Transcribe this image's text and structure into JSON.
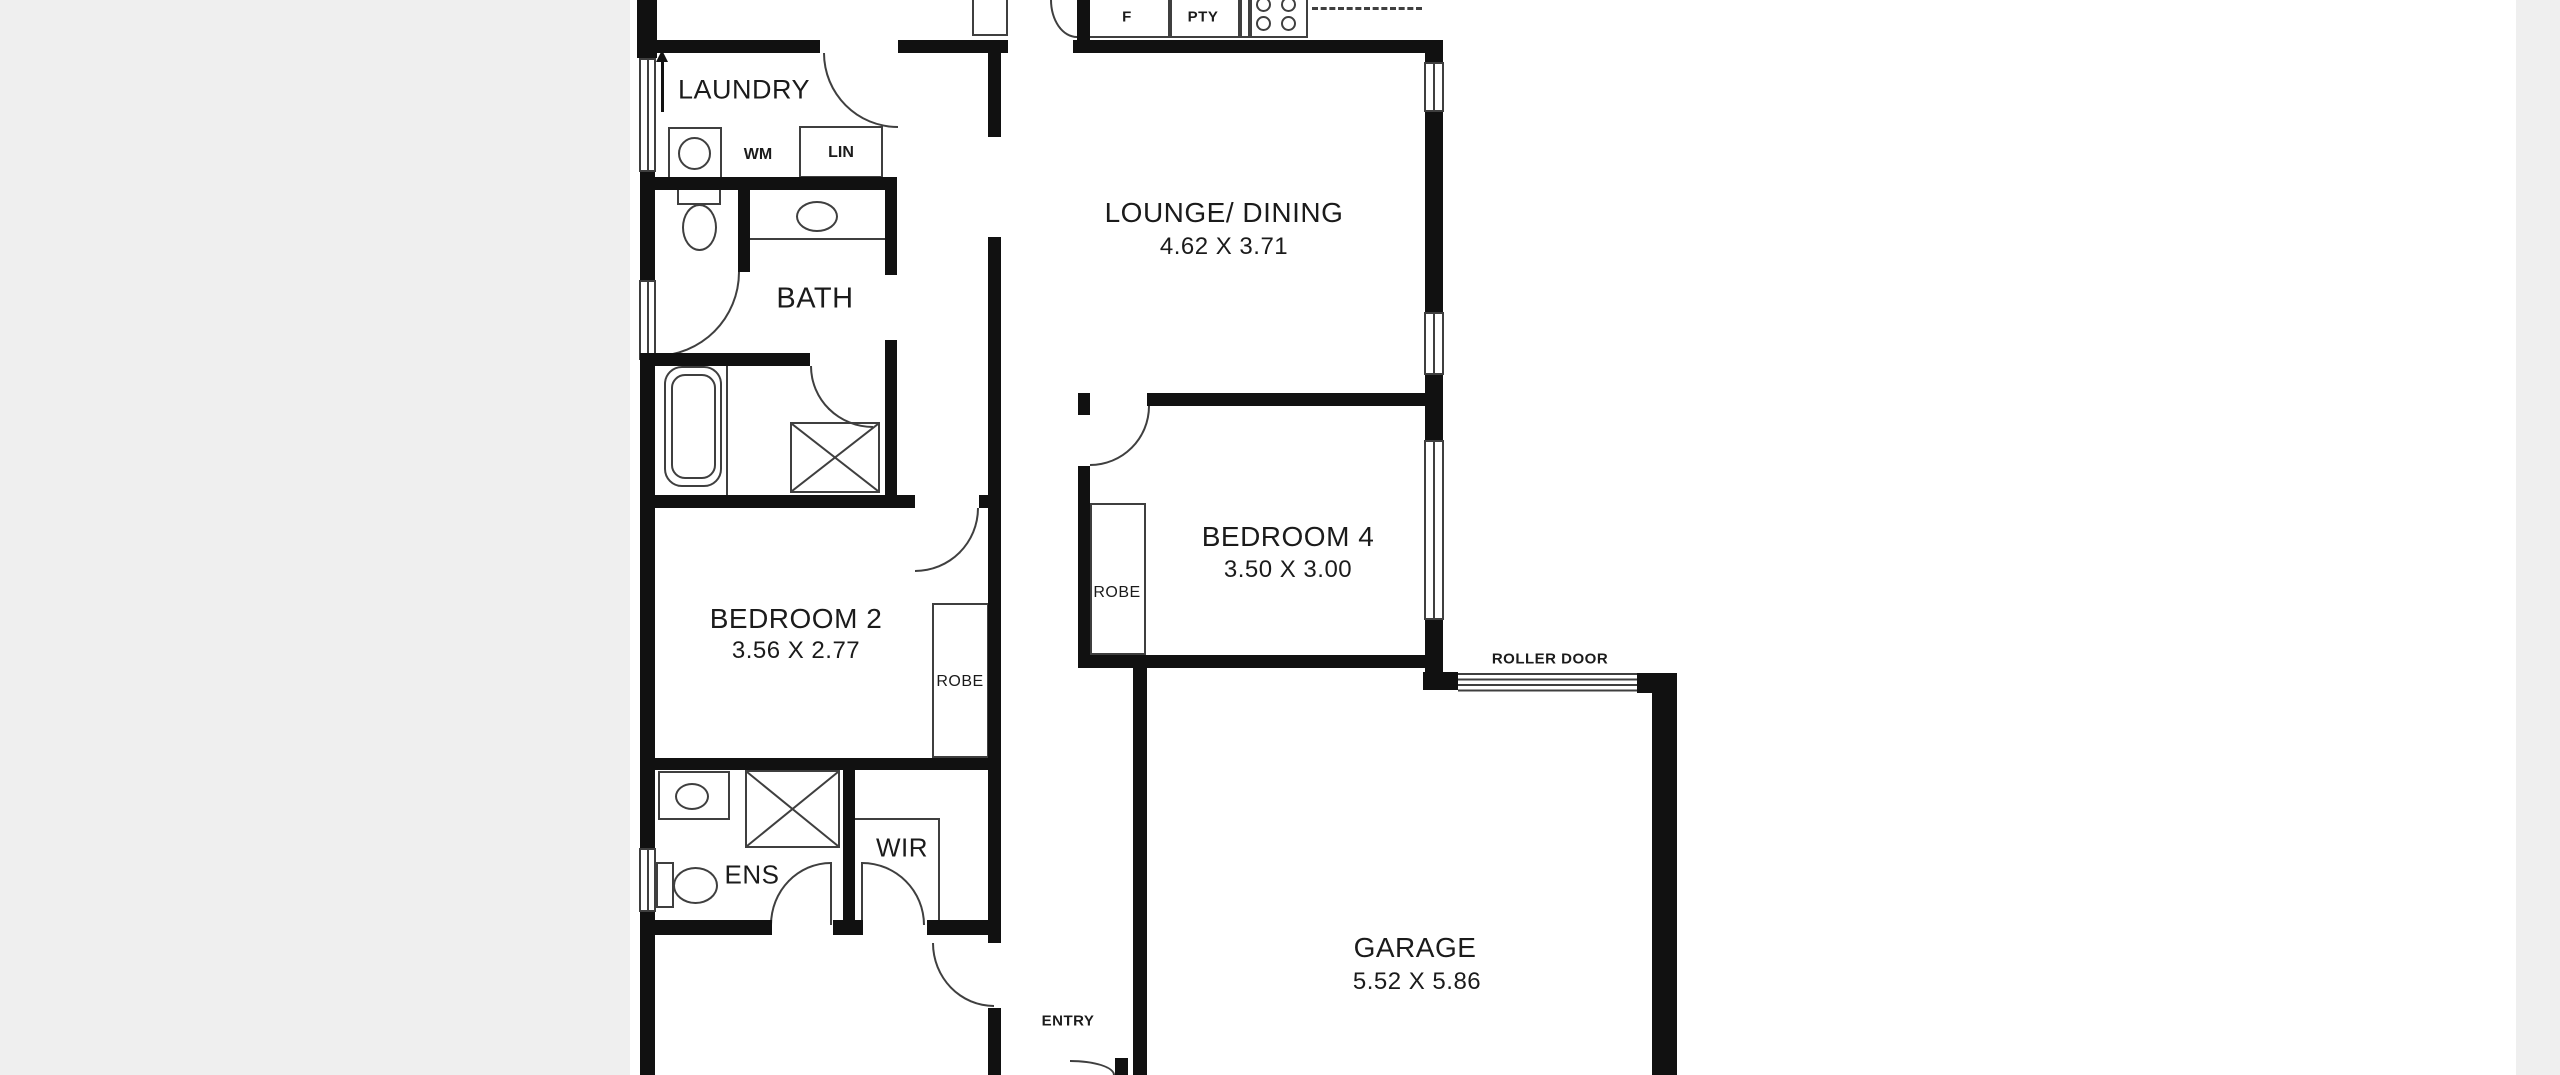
{
  "colors": {
    "canvas_bg": "#efefef",
    "photo_bg": "#ffffff",
    "wall": "#111111",
    "line": "#3f3f3f",
    "text": "#1b1b1b"
  },
  "rooms": {
    "laundry": {
      "label": "LAUNDRY"
    },
    "bath": {
      "label": "BATH"
    },
    "lounge_dining": {
      "label": "LOUNGE/ DINING",
      "dims": "4.62 X 3.71"
    },
    "bedroom4": {
      "label": "BEDROOM 4",
      "dims": "3.50 X 3.00",
      "robe": "ROBE"
    },
    "bedroom2": {
      "label": "BEDROOM 2",
      "dims": "3.56 X 2.77",
      "robe": "ROBE"
    },
    "ensuite": {
      "label": "ENS"
    },
    "wir": {
      "label": "WIR"
    },
    "garage": {
      "label": "GARAGE",
      "dims": "5.52 X 5.86"
    },
    "entry": {
      "label": "ENTRY"
    }
  },
  "fixtures": {
    "washing_machine": "WM",
    "linen": "LIN",
    "fridge": "F",
    "pantry": "PTY",
    "roller_door": "ROLLER DOOR"
  }
}
